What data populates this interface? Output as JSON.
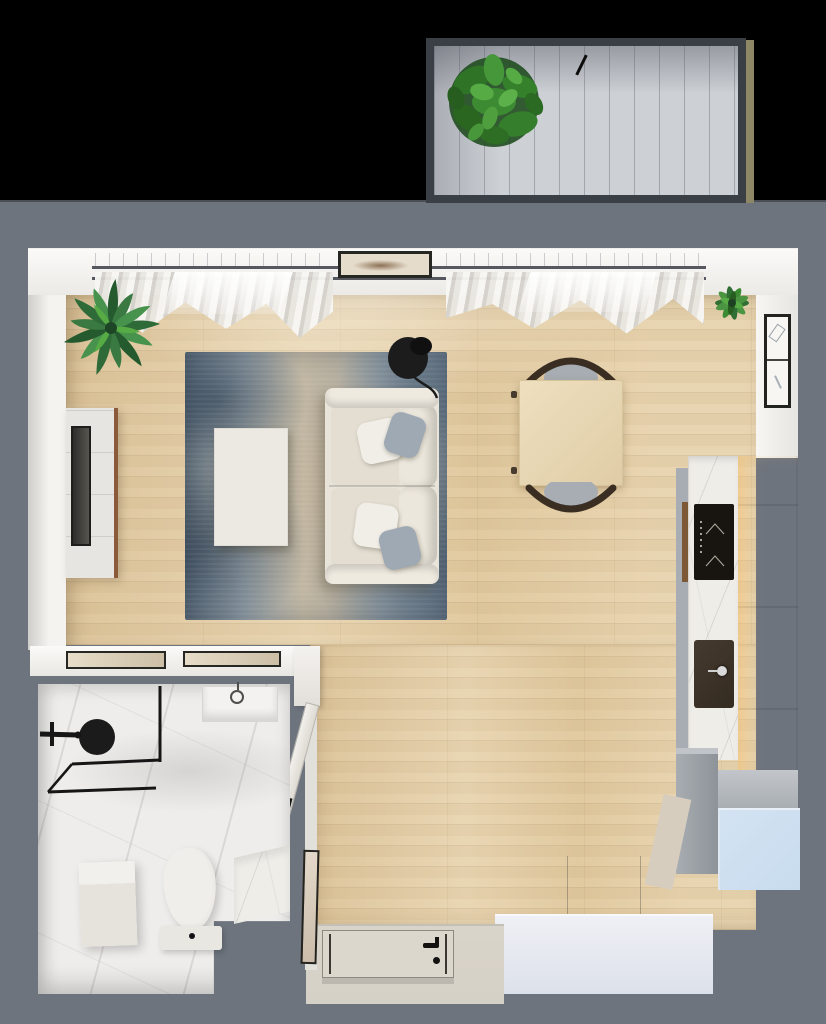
{
  "meta": {
    "title": "3D top-view floor plan of a studio apartment with balcony, living-dining area, kitchen, entry and bathroom",
    "canvas": {
      "width": 826,
      "height": 1024
    }
  },
  "colors": {
    "surround": "#6e747e",
    "blackTop": "#000000",
    "wood": "#e4cda3",
    "woodTrim": "#8a5a3a",
    "deck": "#cdd0d5",
    "balconyFrame": "#3a3f45",
    "balconySide": "#8e8765",
    "rail": "#55595f",
    "glass": "#e7ebef",
    "curtain": "#e9e7e2",
    "rugDark": "#5e6e7d",
    "rugMid": "#93a0a9",
    "rugBeige": "#c0b6a2",
    "sofa": "#e9e4da",
    "pillowWhite": "#f1eee7",
    "pillowBlue": "#9fa9b4",
    "coffeeTable": "#ece9e2",
    "tableWood": "#e7d6b0",
    "chairFrame": "#3a2d22",
    "chairSeat": "#a7adb3",
    "lamp": "#1c1c1c",
    "marble": "#efede8",
    "cooktop": "#181410",
    "sink": "#342b21",
    "faucet": "#d9d9d9",
    "cabinetCream": "#f3efe6",
    "cabinetGlow": "#f6e7c6",
    "unitGray": "#9aa0a6",
    "unitBlue": "#c8dcee",
    "wardrobeTop": "#d8cec0",
    "wardrobeFront": "#e9ecf2",
    "doorBeige": "#dcd7cc",
    "landing": "#d6d1c7",
    "bathMarble": "#eeedeb",
    "fixtureBlack": "#1b1b1b",
    "plantDark": "#2a6130",
    "plantMid": "#3f8a3c",
    "plantLight": "#5aa84a",
    "artFrame": "#262622",
    "artPaper": "#e5dccb"
  },
  "scene": {
    "balcony": {
      "items": [
        "potted-tree",
        "plank-decking",
        "door-mark",
        "side-trim"
      ]
    },
    "living_room": {
      "items": [
        "window-glazing",
        "curtain-rails",
        "curtains",
        "sheer-curtain",
        "wall-art-landscape",
        "palm-plant",
        "tv-console",
        "tv-screen",
        "area-rug",
        "coffee-table",
        "sofa",
        "throw-pillows",
        "floor-lamp"
      ]
    },
    "dining": {
      "items": [
        "square-wood-table",
        "chair-north",
        "chair-south"
      ]
    },
    "kitchen": {
      "items": [
        "marble-counter",
        "induction-cooktop",
        "undermount-sink",
        "faucet",
        "tall-cabinet-column",
        "base-unit-gray",
        "blue-unit",
        "wall-art-sketch",
        "corner-plant"
      ]
    },
    "entry": {
      "items": [
        "front-door",
        "door-handle",
        "landing",
        "open-bathroom-door",
        "door-jamb-cabinet",
        "leaning-picture",
        "wardrobe"
      ]
    },
    "bathroom": {
      "items": [
        "walk-in-shower",
        "shower-head",
        "glass-partition",
        "wall-niche",
        "round-mirror",
        "washing-machine",
        "toilet",
        "vanity-counter",
        "picture-frames-on-ledge"
      ]
    }
  }
}
